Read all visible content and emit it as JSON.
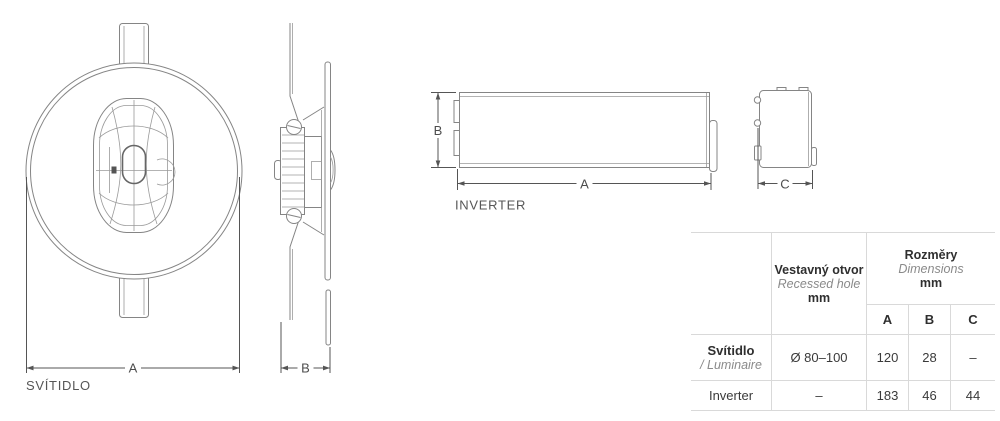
{
  "drawings": {
    "luminaire": {
      "caption": "SVÍTIDLO",
      "dim_width_label": "A",
      "dim_depth_label": "B"
    },
    "inverter": {
      "caption": "INVERTER",
      "dim_length_label": "A",
      "dim_height_label": "B",
      "dim_depth_label": "C"
    }
  },
  "table": {
    "recessed_header": {
      "cs": "Vestavný otvor",
      "en": "Recessed hole",
      "unit": "mm"
    },
    "dimensions_header": {
      "cs": "Rozměry",
      "en": "Dimensions",
      "unit": "mm"
    },
    "dim_columns": [
      "A",
      "B",
      "C"
    ],
    "rows": [
      {
        "name_cs": "Svítidlo",
        "name_en": "/ Luminaire",
        "recessed_hole": "Ø 80–100",
        "a": "120",
        "b": "28",
        "c": "–"
      },
      {
        "name_cs": "Inverter",
        "name_en": "",
        "recessed_hole": "–",
        "a": "183",
        "b": "46",
        "c": "44"
      }
    ]
  },
  "colors": {
    "drawing_line": "#858585",
    "dimension_line": "#555555",
    "table_border": "#d9d9d9",
    "text": "#3a3a3a",
    "muted_text": "#8a8a8a"
  }
}
